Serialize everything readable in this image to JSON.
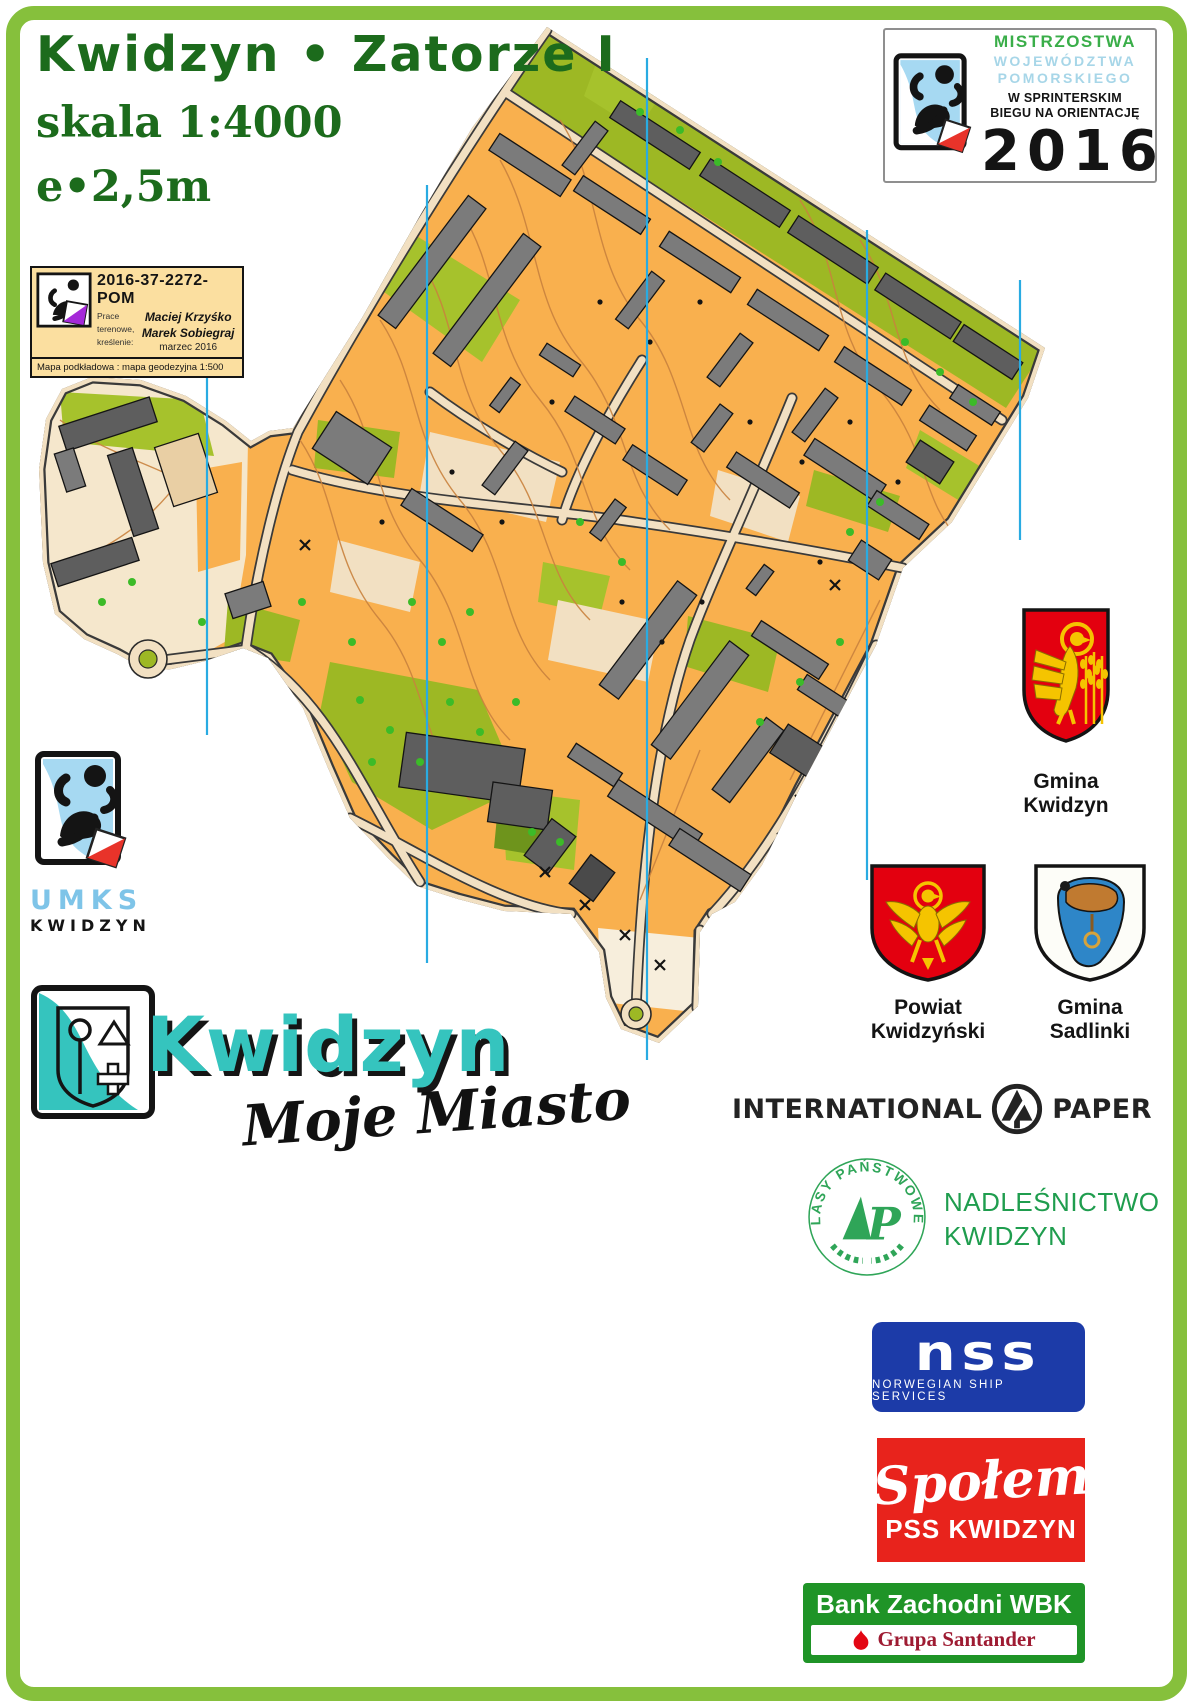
{
  "poster": {
    "border_color": "#86C03C",
    "background": "#FFFFFF"
  },
  "title": {
    "name": "Kwidzyn • Zatorze I",
    "scale": "skala 1:4000",
    "contour_interval": "e•2,5m"
  },
  "championship_badge": {
    "line1": "MISTRZOSTWA",
    "line2": "WOJEWÓDZTWA",
    "line3": "POMORSKIEGO",
    "line4": "W SPRINTERSKIM",
    "line5": "BIEGU NA ORIENTACJĘ",
    "year": "2016"
  },
  "registration_card": {
    "code": "2016-37-2272-POM",
    "labels": [
      "Prace",
      "terenowe,",
      "kreślenie:"
    ],
    "person1": "Maciej Krzyśko",
    "person2": "Marek Sobiegraj",
    "date": "marzec 2016",
    "base_label": "Mapa podkładowa :",
    "base_value": "mapa geodezyjna 1:500"
  },
  "umks": {
    "line1": "UMKS",
    "line2": "KWIDZYN"
  },
  "city_logo": {
    "name": "Kwidzyn",
    "subtitle": "Moje Miasto"
  },
  "coats_of_arms": {
    "gmina_kwidzyn": {
      "line1": "Gmina",
      "line2": "Kwidzyn"
    },
    "powiat_kwidzynski": {
      "line1": "Powiat",
      "line2": "Kwidzyński"
    },
    "gmina_sadlinki": {
      "line1": "Gmina",
      "line2": "Sadlinki"
    }
  },
  "sponsors": {
    "international_paper": {
      "word1": "INTERNATIONAL",
      "word2": "PAPER"
    },
    "lasy_panstwowe": {
      "stamp_text": "LASY PAŃSTWOWE",
      "line1": "NADLEŚNICTWO",
      "line2": "KWIDZYN"
    },
    "nss": {
      "name": "nss",
      "subtitle": "NORWEGIAN SHIP SERVICES"
    },
    "spolem": {
      "script": "Społem",
      "subtitle": "PSS KWIDZYN"
    },
    "bank": {
      "name": "Bank Zachodni WBK",
      "group": "Grupa Santander"
    }
  },
  "map": {
    "colors": {
      "open_orange": "#F9B04E",
      "paved": "#F2E0C2",
      "vegetation": "#9DB824",
      "building": "#7B7B7B",
      "north_line": "#29ABE2",
      "contour": "#C9823E"
    }
  }
}
